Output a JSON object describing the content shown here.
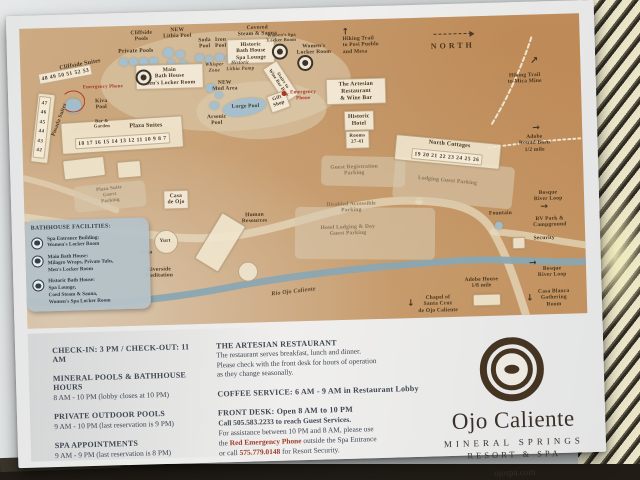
{
  "map": {
    "legend": {
      "title": "BATHHOUSE FACILITIES:",
      "items": [
        {
          "icon": "facility-target-icon",
          "text": "Spa Entrance Building:\nWomen's Locker Room"
        },
        {
          "icon": "facility-target-icon",
          "text": "Main Bath House:\nMilagro Wraps, Private Tubs,\nMen's Locker Room"
        },
        {
          "icon": "facility-target-icon",
          "text": "Historic Bath House:\nSpa Lounge,\nCoed Steam & Sauna,\nWomen's Spa Locker Room"
        }
      ]
    },
    "labels": [
      {
        "id": "cliffside-suites-label",
        "t": "Cliffside Suites",
        "x": 60,
        "y": 38,
        "r": -9,
        "s": 6
      },
      {
        "id": "cliffside-suites-numbers",
        "t": "48 49 50 51 52 53",
        "x": 45,
        "y": 47,
        "r": -9,
        "c": "numbox"
      },
      {
        "id": "private-pools-label",
        "t": "Private Pools",
        "x": 116,
        "y": 26,
        "s": 5.8
      },
      {
        "id": "cliffside-pools-label",
        "t": "Cliffside\nPools",
        "x": 122,
        "y": 11
      },
      {
        "id": "new-lithia-pool-label",
        "t": "NEW\nLithia Pool",
        "x": 158,
        "y": 9
      },
      {
        "id": "soda-pool-label",
        "t": "Soda\nPool",
        "x": 185,
        "y": 20
      },
      {
        "id": "iron-pool-label",
        "t": "Iron\nPool",
        "x": 201,
        "y": 20
      },
      {
        "id": "covered-steam-sauna-label",
        "t": "Covered\nSteam & Sauna",
        "x": 238,
        "y": 9
      },
      {
        "id": "covered-steam-arrow",
        "t": "↓",
        "c": "arrow",
        "x": 247,
        "y": 19,
        "s": 7
      },
      {
        "id": "historic-bath-house-box",
        "t": "Historic\nBath House\nSpa Lounge",
        "x": 231,
        "y": 29,
        "c": "box",
        "w": 40
      },
      {
        "id": "facility-icon-historic-bath",
        "c": "facicon",
        "x": 260,
        "y": 30
      },
      {
        "id": "womens-spa-locker-label",
        "t": "Women's Spa\nLocker Room",
        "x": 262,
        "y": 16,
        "s": 4.6
      },
      {
        "id": "womens-locker-room-label",
        "t": "Women's\nLocker Room",
        "x": 294,
        "y": 29
      },
      {
        "id": "facility-icon-spa-entrance",
        "c": "facicon",
        "x": 285,
        "y": 42
      },
      {
        "id": "stairs-wine-bar-box",
        "t": "Stairs to\nWine Bar Deck",
        "x": 260,
        "y": 60,
        "r": 58,
        "c": "box",
        "s": 4.6
      },
      {
        "id": "gift-shop-box",
        "t": "Gift\nShop",
        "x": 257,
        "y": 80,
        "r": -18,
        "c": "box",
        "s": 5
      },
      {
        "id": "emergency-phone-dot-spa",
        "c": "reddot",
        "x": 263,
        "y": 72
      },
      {
        "id": "emergency-phone-spa-label",
        "t": "Emergency\nPhone",
        "x": 282,
        "y": 75,
        "c": "red",
        "s": 5
      },
      {
        "id": "main-bath-house-box",
        "t": "Main\nBath House\nMen's Locker Room",
        "x": 149,
        "y": 52,
        "c": "box",
        "w": 60
      },
      {
        "id": "facility-icon-main-bath",
        "c": "facicon",
        "x": 123,
        "y": 52
      },
      {
        "id": "whisper-zone-label",
        "t": "Whisper\nZone",
        "x": 194,
        "y": 45,
        "c": "ital",
        "s": 5
      },
      {
        "id": "historic-lithia-pump-label",
        "t": "Historic\nLithia Pump",
        "x": 220,
        "y": 44,
        "c": "ital",
        "s": 5
      },
      {
        "id": "new-mud-area-label",
        "t": "NEW\nMud Area",
        "x": 204,
        "y": 63
      },
      {
        "id": "large-pool-label",
        "t": "Large Pool",
        "x": 224,
        "y": 84
      },
      {
        "id": "arsenic-pool-label",
        "t": "Arsenic\nPool",
        "x": 195,
        "y": 97
      },
      {
        "id": "kiva-pool-label",
        "t": "Kiva\nPool",
        "x": 80,
        "y": 78
      },
      {
        "id": "emergency-phone-kiva-label",
        "t": "Emergency Phone",
        "x": 82,
        "y": 61,
        "c": "red",
        "s": 4.8
      },
      {
        "id": "emergency-phone-arc-kiva",
        "c": "redarc",
        "x": 52,
        "y": 74,
        "w": 22,
        "h": 20
      },
      {
        "id": "posada-suites-label",
        "t": "Posada Suites",
        "x": 38,
        "y": 92,
        "r": -68
      },
      {
        "id": "posada-suites-numbers",
        "t": "47\n46\n45\n44\n43\n42",
        "x": 20,
        "y": 99,
        "r": 8,
        "c": "numbox tallnums",
        "s": 5
      },
      {
        "id": "plaza-suites-label",
        "t": "Plaza Suites",
        "x": 124,
        "y": 101,
        "s": 6
      },
      {
        "id": "plaza-suites-numbers",
        "t": "18 17 16 15 14 13 12 11 10 9 8 7",
        "x": 100,
        "y": 115,
        "r": -2,
        "c": "numbox"
      },
      {
        "id": "bar-garden-label",
        "t": "Bar &\nGarden",
        "x": 80,
        "y": 97,
        "s": 4.6
      },
      {
        "id": "hiking-trail-posi-label",
        "t": "Hiking Trail\nto Posi Pueblo\nand Mesa",
        "x": 341,
        "y": 26,
        "c": "left"
      },
      {
        "id": "hiking-trail-posi-arrow",
        "t": "↑",
        "c": "arrow",
        "x": 326,
        "y": 13,
        "s": 9
      },
      {
        "id": "north-label",
        "t": "NORTH",
        "x": 433,
        "y": 29,
        "c": "north",
        "s": 8
      },
      {
        "id": "north-arrow",
        "c": "dasharrow",
        "x": 433,
        "y": 17
      },
      {
        "id": "hiking-trail-mica-label",
        "t": "Hiking Trail\nto Mica Mine",
        "x": 504,
        "y": 64
      },
      {
        "id": "hiking-trail-mica-arrow",
        "t": "↗",
        "c": "arrow",
        "x": 514,
        "y": 47,
        "s": 10
      },
      {
        "id": "artesian-restaurant-box",
        "t": "The Artesian\nRestaurant\n& Wine Bar",
        "x": 335,
        "y": 72,
        "c": "box",
        "s": 5.8,
        "w": 52
      },
      {
        "id": "historic-hotel-box",
        "t": "Historic\nHotel",
        "x": 337,
        "y": 101,
        "c": "box",
        "s": 5.8
      },
      {
        "id": "hotel-rooms-box",
        "t": "Rooms\n27-41",
        "x": 335,
        "y": 120,
        "c": "box",
        "s": 5
      },
      {
        "id": "north-cottages-label",
        "t": "North Cottages",
        "x": 427,
        "y": 128,
        "r": 7,
        "s": 6
      },
      {
        "id": "north-cottages-numbers",
        "t": "19 20 21 22 23 24 25 26",
        "x": 424,
        "y": 140,
        "r": 7,
        "c": "numbox"
      },
      {
        "id": "adobe-round-barn-label",
        "t": "Adobe\nRound Barn\n1/2 mile",
        "x": 512,
        "y": 129
      },
      {
        "id": "adobe-round-barn-arrow",
        "t": "→",
        "c": "arrow",
        "x": 514,
        "y": 114,
        "s": 9
      },
      {
        "id": "guest-registration-parking-label",
        "t": "Guest Registration\nParking",
        "x": 331,
        "y": 151,
        "c": "faint"
      },
      {
        "id": "lodging-guest-parking-label",
        "t": "Lodging Guest Parking",
        "x": 424,
        "y": 164,
        "r": 7,
        "c": "faint"
      },
      {
        "id": "plaza-suite-parking-label",
        "t": "Plaza Suite\nGuest\nParking",
        "x": 86,
        "y": 169,
        "r": -5,
        "c": "faint",
        "s": 5
      },
      {
        "id": "casa-de-ojo-box",
        "t": "Casa\nde Ojo",
        "x": 152,
        "y": 175,
        "c": "box"
      },
      {
        "id": "disabled-parking-label",
        "t": "Disabled Accessible\nParking",
        "x": 327,
        "y": 188,
        "c": "faint"
      },
      {
        "id": "hotel-lodging-parking-label",
        "t": "Hotel Lodging & Day\nGuest Parking",
        "x": 323,
        "y": 211,
        "c": "faint"
      },
      {
        "id": "fountain-label",
        "t": "Fountain",
        "x": 476,
        "y": 198
      },
      {
        "id": "bosque-river-loop-label-1",
        "t": "Bosque\nRiver Loop",
        "x": 524,
        "y": 182
      },
      {
        "id": "bosque-arrow-1",
        "t": "→",
        "c": "arrow",
        "x": 520,
        "y": 193,
        "s": 9
      },
      {
        "id": "rv-park-label",
        "t": "RV Park &\nCampground",
        "x": 525,
        "y": 208
      },
      {
        "id": "security-label",
        "t": "Security",
        "x": 519,
        "y": 224
      },
      {
        "id": "human-resources-label",
        "t": "Human\nResources",
        "x": 230,
        "y": 196
      },
      {
        "id": "yurt-label",
        "t": "Yurt",
        "x": 140,
        "y": 216,
        "s": 5.2
      },
      {
        "id": "yoga-label",
        "t": "Yoga",
        "x": 121,
        "y": 227,
        "s": 5.2
      },
      {
        "id": "riverside-meditation-label",
        "t": "Riverside\nMeditation",
        "x": 133,
        "y": 248
      },
      {
        "id": "rio-ojo-caliente-label",
        "t": "Rio Ojo Caliente",
        "x": 267,
        "y": 271,
        "r": -5,
        "c": "ital",
        "s": 6
      },
      {
        "id": "adobe-house-label",
        "t": "Adobe House\n1/8 mile",
        "x": 455,
        "y": 267
      },
      {
        "id": "chapel-label",
        "t": "Chapel of\nSanta Cruz\nde Ojo Caliente",
        "x": 411,
        "y": 287
      },
      {
        "id": "chapel-arrow",
        "t": "↓",
        "c": "arrow",
        "x": 384,
        "y": 286,
        "s": 9
      },
      {
        "id": "bosque-river-loop-label-2",
        "t": "Bosque River Loop",
        "x": 526,
        "y": 258
      },
      {
        "id": "bosque-arrow-2",
        "t": "→",
        "c": "arrow",
        "x": 507,
        "y": 249,
        "s": 9
      },
      {
        "id": "casa-blanca-label",
        "t": "Casa Blanca\nGathering\nRoom",
        "x": 527,
        "y": 284
      },
      {
        "id": "casa-blanca-arrow",
        "t": "↓",
        "c": "arrow",
        "x": 503,
        "y": 284,
        "s": 9
      }
    ],
    "pools": [
      [
        103,
        36,
        9,
        8
      ],
      [
        113,
        36,
        9,
        8
      ],
      [
        123,
        36,
        9,
        8
      ],
      [
        133,
        36,
        9,
        8
      ],
      [
        148,
        28,
        11,
        10
      ],
      [
        160,
        30,
        9,
        8
      ],
      [
        151,
        38,
        8,
        7
      ],
      [
        163,
        40,
        10,
        9
      ],
      [
        179,
        34,
        9,
        8
      ],
      [
        189,
        35,
        8,
        7
      ],
      [
        199,
        34,
        9,
        8
      ],
      [
        209,
        35,
        8,
        7
      ],
      [
        190,
        64,
        10,
        9
      ],
      [
        198,
        71,
        8,
        7
      ],
      [
        193,
        82,
        10,
        8
      ],
      [
        223,
        84,
        44,
        17,
        -8
      ],
      [
        52,
        78,
        16,
        15
      ],
      [
        474,
        210,
        8,
        8
      ]
    ],
    "zones": [
      {
        "x": 205,
        "y": 58,
        "w": 250,
        "h": 100,
        "c": "plaza"
      },
      {
        "x": 240,
        "y": 88,
        "w": 130,
        "h": 58,
        "c": "plaza"
      },
      {
        "x": 86,
        "y": 170,
        "w": 72,
        "h": 26,
        "r": -4,
        "c": "lot"
      },
      {
        "x": 340,
        "y": 152,
        "w": 84,
        "h": 30,
        "r": 3,
        "c": "lot"
      },
      {
        "x": 430,
        "y": 166,
        "w": 120,
        "h": 42,
        "r": 7,
        "c": "lot"
      },
      {
        "x": 340,
        "y": 214,
        "w": 140,
        "h": 52,
        "r": 2,
        "c": "lot"
      },
      {
        "x": 99,
        "y": 108,
        "w": 120,
        "h": 30,
        "r": -2,
        "c": "bldg"
      },
      {
        "x": 20,
        "y": 99,
        "w": 16,
        "h": 68,
        "r": 8,
        "c": "bldg"
      },
      {
        "x": 424,
        "y": 134,
        "w": 104,
        "h": 24,
        "r": 7,
        "c": "bldg"
      },
      {
        "x": 194,
        "y": 218,
        "w": 26,
        "h": 52,
        "r": 33,
        "c": "bldg"
      },
      {
        "x": 221,
        "y": 248,
        "w": 18,
        "h": 18,
        "c": "bldgc"
      },
      {
        "x": 140,
        "y": 216,
        "w": 22,
        "h": 22,
        "c": "bldgc"
      },
      {
        "x": 459,
        "y": 283,
        "w": 26,
        "h": 10,
        "c": "bldg"
      },
      {
        "x": 492,
        "y": 227,
        "w": 11,
        "h": 10,
        "c": "bldg"
      },
      {
        "x": 60,
        "y": 140,
        "w": 40,
        "h": 18,
        "r": -5,
        "c": "bldg"
      },
      {
        "x": 105,
        "y": 142,
        "w": 22,
        "h": 15,
        "r": -3,
        "c": "bldg"
      }
    ],
    "paths": [
      {
        "d": "M 500,305 C 488,262 480,238 468,216 C 455,192 430,185 395,183",
        "stroke": "#e6d9bd",
        "w": 8,
        "o": 0.75
      },
      {
        "d": "M 395,183 C 330,178 280,203 215,212 C 160,220 110,206 55,198 C 30,194 10,190 -5,188",
        "stroke": "#e6d9bd",
        "w": 8,
        "o": 0.75
      },
      {
        "d": "M 468,216 C 495,218 525,226 562,232",
        "stroke": "#e6d9bd",
        "w": 7,
        "o": 0.75
      },
      {
        "d": "M -5,148 C 35,158 65,172 92,184",
        "stroke": "#e6d9bd",
        "w": 6,
        "o": 0.6
      },
      {
        "d": "M -5,272 C 60,281 140,275 210,263 C 290,251 360,247 430,244 C 480,242 525,250 565,248",
        "stroke": "#8aa7b2",
        "w": 7,
        "o": 0.95
      },
      {
        "d": "M 470,108 C 488,80 502,50 512,22",
        "stroke": "#f4ecd8",
        "w": 2,
        "o": 0.9,
        "dash": "4 3"
      },
      {
        "d": "M 466,132 C 498,128 530,126 560,125",
        "stroke": "#f4ecd8",
        "w": 2,
        "o": 0.9,
        "dash": "2 3"
      }
    ]
  },
  "info": {
    "left": [
      {
        "heading": "CHECK-IN: 3 PM / CHECK-OUT: 11 AM",
        "body": ""
      },
      {
        "heading": "MINERAL POOLS & BATHHOUSE HOURS",
        "body": "8 AM - 10 PM (lobby closes at 10 PM)"
      },
      {
        "heading": "PRIVATE OUTDOOR POOLS",
        "body": "9 AM - 10 PM (last reservation is 9 PM)"
      },
      {
        "heading": "SPA APPOINTMENTS",
        "body": "9 AM - 9 PM (last reservation is 8 PM)"
      }
    ],
    "center": {
      "restaurant_title": "THE ARTESIAN RESTAURANT",
      "restaurant_body": "The restaurant serves breakfast, lunch and dinner.\nPlease check with the front desk for hours of operation\nas they change seasonally.",
      "coffee": "COFFEE SERVICE: 6 AM - 9 AM in Restaurant Lobby",
      "frontdesk_title": "FRONT DESK: Open 8 AM to 10 PM",
      "frontdesk_line2": "Call 505.583.2233 to reach Guest Services.",
      "frontdesk_line3": "For assistance between 10 PM and 8 AM, please use",
      "frontdesk_line4_pre": "the ",
      "frontdesk_line4_red": "Red Emergency Phone",
      "frontdesk_line4_post": " outside the Spa Entrance",
      "frontdesk_line5_pre": "or call ",
      "frontdesk_line5_red": "575.779.0148",
      "frontdesk_line5_post": " for Resort Security."
    }
  },
  "brand": {
    "name": "Ojo Caliente",
    "line1": "MINERAL SPRINGS",
    "line2": "RESORT & SPA",
    "site": "ojospa.com"
  }
}
